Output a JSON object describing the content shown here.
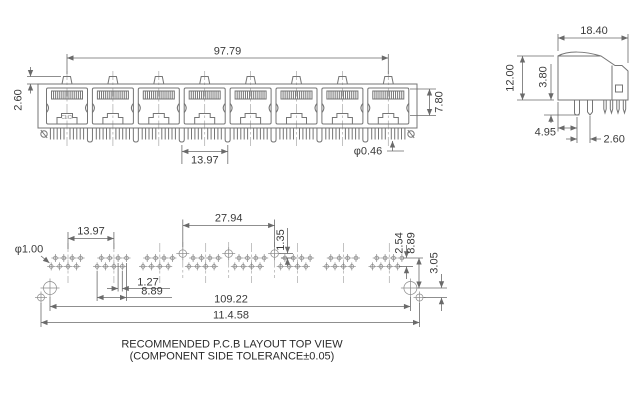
{
  "front": {
    "port_count": 8,
    "logo": "CLCI",
    "dims": {
      "span": "97.79",
      "latch": "2.60",
      "pitch": "13.97",
      "height": "7.80",
      "pin_dia": "φ0.46"
    }
  },
  "side": {
    "dims": {
      "depth": "18.40",
      "height": "12.00",
      "standoff": "3.80",
      "back_to_peg": "4.95",
      "peg_to_pin": "2.60"
    }
  },
  "pcb": {
    "dims": {
      "pitch": "13.97",
      "hole_dia": "φ1.00",
      "peg_span": "27.94",
      "peg_offset": "1.35",
      "stagger": "1.27",
      "group_span": "8.89",
      "row_pitch": "2.54",
      "row_to_mount": "8.89",
      "mount_to_aux": "3.05",
      "mount_span": "109.22",
      "overall": "11.4.58"
    },
    "caption1": "RECOMMENDED P.C.B LAYOUT TOP VIEW",
    "caption2": "(COMPONENT SIDE TOLERANCE±0.05)"
  }
}
